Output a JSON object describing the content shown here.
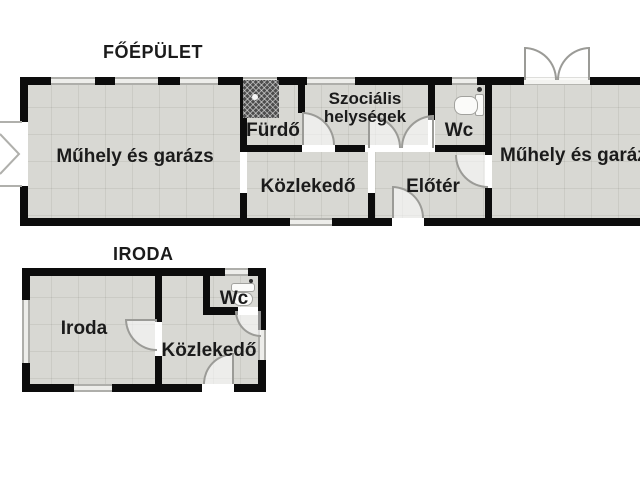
{
  "colors": {
    "background": "#ffffff",
    "wall": "#0c0c0c",
    "floor": "#d8d8d3",
    "window_frame": "#aeaeaa",
    "door_arc": "#9b9b97"
  },
  "main_building": {
    "title": "FŐÉPÜLET",
    "rooms": {
      "workshop_garage_left": "Műhely és garázs",
      "bathroom": "Fürdő",
      "social_rooms": "Szociális helységek",
      "wc": "Wc",
      "corridor": "Közlekedő",
      "foyer": "Előtér",
      "workshop_garage_right": "Műhely és garázs"
    }
  },
  "office_building": {
    "title": "IRODA",
    "rooms": {
      "office": "Iroda",
      "wc": "Wc",
      "corridor": "Közlekedő"
    }
  }
}
